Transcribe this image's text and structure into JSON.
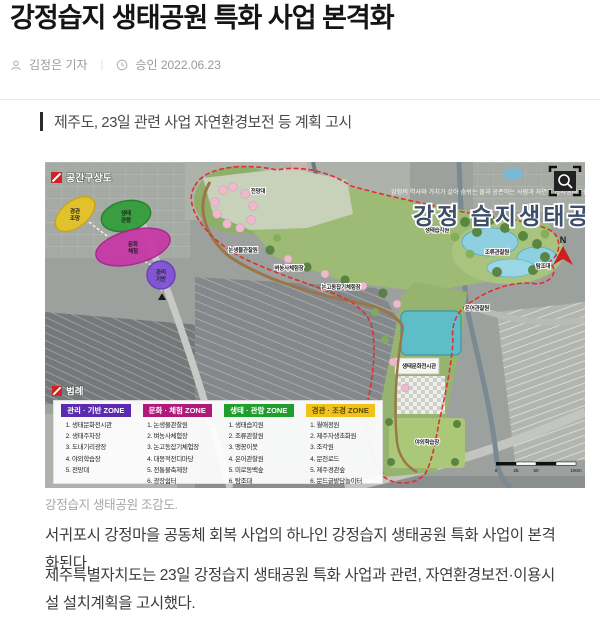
{
  "article": {
    "title": "강정습지 생태공원 특화 사업 본격화",
    "byline": {
      "reporter": "김정은 기자",
      "separator": "|",
      "approved": "승인 2022.06.23"
    },
    "subheading": "제주도, 23일 관련 사업 자연환경보전 등 계획 고시",
    "caption": "강정습지 생태공원 조감도.",
    "paragraphs": {
      "p1": "서귀포시 강정마을 공동체 회복 사업의 하나인 강정습지 생태공원 특화 사업이 본격화된다.",
      "p2": "제주특별자치도는 23일 강정습지 생태공원 특화 사업과 관련, 자연환경보전·이용시설 설치계획을 고시했다."
    }
  },
  "map": {
    "title": "강정 습지생태공원",
    "subtitle": "강정의 역사와 가치가 살아 숨쉬는 물과 공존하는 사람과 자연의 습지생태공원",
    "concept_label": "공간구상도",
    "legend_label": "범례",
    "north_label": "N",
    "boundary_color": "#e03030",
    "zone_bubbles": [
      {
        "line1": "경관",
        "line2": "조망",
        "color": "#e6c322"
      },
      {
        "line1": "생태",
        "line2": "관람",
        "color": "#2f9e38"
      },
      {
        "line1": "문화",
        "line2": "체험",
        "color": "#c635a5"
      },
      {
        "line1": "관리",
        "line2": "기반",
        "color": "#8050d8"
      }
    ],
    "site_labels": [
      "전망대",
      "논생물관찰원",
      "벼농사체험장",
      "논고동잡기체험장",
      "생태습지원",
      "조류관찰원",
      "탐조대",
      "은어관찰원",
      "생태문화전시관",
      "야외학습장"
    ],
    "legend": {
      "zones": [
        {
          "name": "관리 · 기반 ZONE",
          "color": "#5b2ab0",
          "items": [
            "생태문화전시관",
            "생태주차장",
            "도내기리광장",
            "야외학습장",
            "전망대"
          ]
        },
        {
          "name": "문화 · 체험 ZONE",
          "color": "#b0187a",
          "items": [
            "논생물관찰원",
            "벼농사체험장",
            "논고동잡기체험장",
            "대몽적전디마당",
            "전통물축제장",
            "광장쉼터"
          ]
        },
        {
          "name": "생태 · 관람 ZONE",
          "color": "#1f9e2c",
          "items": [
            "생태습지원",
            "조류관찰원",
            "맹꽁이못",
            "은어관찰원",
            "미로동백숲",
            "탐조대"
          ]
        },
        {
          "name": "경관 · 조경 ZONE",
          "color": "#f2c21c",
          "items": [
            "월애정원",
            "제주자생초화원",
            "조각원",
            "문천로드",
            "제주경관숲",
            "문드글밭담놀이터"
          ]
        }
      ]
    },
    "scale": [
      "0",
      "25",
      "50",
      "100m"
    ]
  }
}
